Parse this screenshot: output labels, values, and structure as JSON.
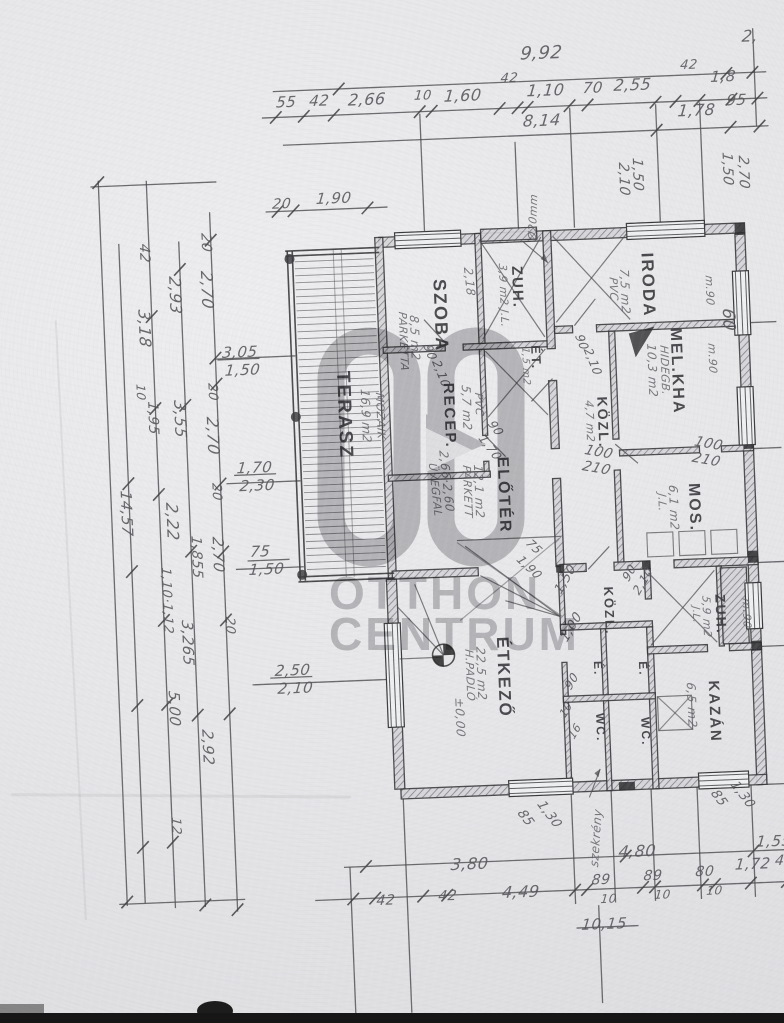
{
  "document": {
    "kind": "scanned hand-drawn floor plan",
    "language": "hu"
  },
  "colors": {
    "paper": "#e8e8ea",
    "ink": "#4b4b4f",
    "ink_dark": "#2b2b2e",
    "watermark_gray": "#97979a",
    "scan_bar": "#161616"
  },
  "watermark": {
    "logo": "OC",
    "line1": "OTTHON",
    "line2": "CENTRUM"
  },
  "labels": [
    {
      "t": "9,92",
      "x": 540,
      "y": 44,
      "fs": 18,
      "n": "dim-overall-top"
    },
    {
      "t": "2,",
      "x": 762,
      "y": 36,
      "fs": 16,
      "n": "dim-top"
    },
    {
      "t": "55",
      "x": 294,
      "y": 84,
      "fs": 15
    },
    {
      "t": "42",
      "x": 327,
      "y": 84,
      "fs": 15
    },
    {
      "t": "2,66",
      "x": 366,
      "y": 84,
      "fs": 16
    },
    {
      "t": "10",
      "x": 432,
      "y": 84,
      "fs": 13
    },
    {
      "t": "1,60",
      "x": 462,
      "y": 84,
      "fs": 16
    },
    {
      "t": "42",
      "x": 519,
      "y": 70,
      "fs": 13
    },
    {
      "t": "1,10",
      "x": 545,
      "y": 82,
      "fs": 16
    },
    {
      "t": "70",
      "x": 601,
      "y": 82,
      "fs": 15
    },
    {
      "t": "2,55",
      "x": 632,
      "y": 80,
      "fs": 16
    },
    {
      "t": "42",
      "x": 699,
      "y": 64,
      "fs": 13
    },
    {
      "t": "1,8",
      "x": 729,
      "y": 76,
      "fs": 15
    },
    {
      "t": "8,14",
      "x": 540,
      "y": 112,
      "fs": 16
    },
    {
      "t": "1,78",
      "x": 695,
      "y": 108,
      "fs": 16
    },
    {
      "t": "95",
      "x": 744,
      "y": 100,
      "fs": 15
    },
    {
      "t": "20",
      "x": 286,
      "y": 186,
      "fs": 14
    },
    {
      "t": "1,90",
      "x": 330,
      "y": 182,
      "fs": 15
    },
    {
      "t": "1,50",
      "x": 658,
      "y": 162,
      "r": 90,
      "fs": 14
    },
    {
      "t": "2,10",
      "x": 644,
      "y": 166,
      "r": 90,
      "fs": 14
    },
    {
      "t": "1,50",
      "x": 748,
      "y": 160,
      "r": 90,
      "fs": 14
    },
    {
      "t": "2,70",
      "x": 764,
      "y": 164,
      "r": 90,
      "fs": 14
    },
    {
      "t": "m.90",
      "x": 724,
      "y": 282,
      "r": 90,
      "fs": 11,
      "c": "hand"
    },
    {
      "t": "m.90",
      "x": 724,
      "y": 350,
      "r": 90,
      "fs": 11,
      "c": "hand"
    },
    {
      "t": "60",
      "x": 744,
      "y": 316,
      "r": 90,
      "fs": 17
    },
    {
      "t": "100",
      "x": 700,
      "y": 440,
      "r": 12,
      "fs": 14
    },
    {
      "t": "210",
      "x": 697,
      "y": 456,
      "r": 12,
      "fs": 14
    },
    {
      "t": "m.90",
      "x": 748,
      "y": 606,
      "r": 90,
      "fs": 11,
      "c": "hand"
    },
    {
      "t": "42",
      "x": 162,
      "y": 228,
      "r": 90,
      "fs": 14
    },
    {
      "t": "20",
      "x": 224,
      "y": 220,
      "r": 90,
      "fs": 14
    },
    {
      "t": "2,93",
      "x": 192,
      "y": 262,
      "r": 90,
      "fs": 16
    },
    {
      "t": "2,70",
      "x": 224,
      "y": 258,
      "r": 90,
      "fs": 16
    },
    {
      "t": "3,18",
      "x": 160,
      "y": 294,
      "r": 90,
      "fs": 16
    },
    {
      "t": "10",
      "x": 152,
      "y": 368,
      "r": 90,
      "fs": 12
    },
    {
      "t": "3,05",
      "x": 230,
      "y": 332,
      "fs": 15
    },
    {
      "t": "1,50",
      "x": 232,
      "y": 350,
      "fs": 15
    },
    {
      "t": "20",
      "x": 224,
      "y": 370,
      "r": 90,
      "fs": 13
    },
    {
      "t": "3,55",
      "x": 192,
      "y": 386,
      "r": 90,
      "fs": 16
    },
    {
      "t": "2,70",
      "x": 224,
      "y": 404,
      "r": 90,
      "fs": 16
    },
    {
      "t": "1,95",
      "x": 164,
      "y": 386,
      "r": 90,
      "fs": 14
    },
    {
      "t": "1,70",
      "x": 240,
      "y": 448,
      "fs": 15
    },
    {
      "t": "2,30",
      "x": 242,
      "y": 466,
      "fs": 15
    },
    {
      "t": "20",
      "x": 224,
      "y": 470,
      "r": 90,
      "fs": 13
    },
    {
      "t": "2,22",
      "x": 180,
      "y": 488,
      "r": 90,
      "fs": 16
    },
    {
      "t": "14,57",
      "x": 134,
      "y": 474,
      "r": 90,
      "fs": 15
    },
    {
      "t": "1,855",
      "x": 202,
      "y": 522,
      "r": 90,
      "fs": 14
    },
    {
      "t": "75",
      "x": 250,
      "y": 532,
      "fs": 15
    },
    {
      "t": "1,50",
      "x": 248,
      "y": 550,
      "fs": 15
    },
    {
      "t": "2,70",
      "x": 224,
      "y": 524,
      "r": 90,
      "fs": 15
    },
    {
      "t": "1,10·1,12",
      "x": 170,
      "y": 552,
      "r": 90,
      "fs": 13
    },
    {
      "t": "20",
      "x": 232,
      "y": 604,
      "r": 90,
      "fs": 13
    },
    {
      "t": "3,265",
      "x": 190,
      "y": 606,
      "r": 90,
      "fs": 15
    },
    {
      "t": "2,50",
      "x": 270,
      "y": 652,
      "fs": 15
    },
    {
      "t": "2,10",
      "x": 272,
      "y": 670,
      "fs": 15
    },
    {
      "t": "5,00",
      "x": 174,
      "y": 676,
      "r": 90,
      "fs": 15
    },
    {
      "t": "2,92",
      "x": 206,
      "y": 716,
      "r": 90,
      "fs": 15
    },
    {
      "t": "12",
      "x": 170,
      "y": 802,
      "r": 90,
      "fs": 13
    },
    {
      "t": "Ø20mm",
      "x": 538,
      "y": 238,
      "r": -86,
      "fs": 11,
      "c": "hand",
      "n": "leader-note"
    },
    {
      "t": "90",
      "x": 592,
      "y": 334,
      "r": 70,
      "fs": 12
    },
    {
      "t": "2,10",
      "x": 600,
      "y": 348,
      "r": 70,
      "fs": 12
    },
    {
      "t": "90",
      "x": 440,
      "y": 338,
      "r": 70,
      "fs": 12
    },
    {
      "t": "2,10",
      "x": 448,
      "y": 354,
      "r": 70,
      "fs": 12
    },
    {
      "t": "2,18",
      "x": 484,
      "y": 264,
      "r": 86,
      "fs": 12,
      "c": "hand"
    },
    {
      "t": "90",
      "x": 500,
      "y": 416,
      "r": 55,
      "fs": 12
    },
    {
      "t": "1,70",
      "x": 490,
      "y": 430,
      "r": 55,
      "fs": 12
    },
    {
      "t": "100",
      "x": 590,
      "y": 444,
      "r": 12,
      "fs": 14
    },
    {
      "t": "210",
      "x": 587,
      "y": 460,
      "r": 12,
      "fs": 14
    },
    {
      "t": "75",
      "x": 532,
      "y": 536,
      "r": 45,
      "fs": 12
    },
    {
      "t": "1,90",
      "x": 522,
      "y": 552,
      "r": 45,
      "fs": 12
    },
    {
      "t": "1,50",
      "x": 550,
      "y": 588,
      "r": -58,
      "fs": 13
    },
    {
      "t": "1,00",
      "x": 554,
      "y": 636,
      "r": -58,
      "fs": 13
    },
    {
      "t": "90",
      "x": 556,
      "y": 684,
      "r": -58,
      "fs": 12
    },
    {
      "t": "10",
      "x": 550,
      "y": 712,
      "r": -58,
      "fs": 11
    },
    {
      "t": "16",
      "x": 558,
      "y": 734,
      "r": -58,
      "fs": 11
    },
    {
      "t": "90",
      "x": 618,
      "y": 578,
      "r": -58,
      "fs": 12
    },
    {
      "t": "2,10",
      "x": 628,
      "y": 592,
      "r": -58,
      "fs": 12
    },
    {
      "t": "±0,00",
      "x": 458,
      "y": 694,
      "r": 90,
      "fs": 12,
      "c": "hand",
      "n": "elevation-value"
    },
    {
      "t": "TERASZ",
      "x": 358,
      "y": 362,
      "r": 90,
      "fs": 19,
      "c": "room",
      "n": "room-terasz"
    },
    {
      "t": "16,9 m2",
      "x": 376,
      "y": 382,
      "r": 90,
      "fs": 12,
      "c": "hand"
    },
    {
      "t": "MOZAIK",
      "x": 390,
      "y": 386,
      "r": 90,
      "fs": 11,
      "c": "hand"
    },
    {
      "t": "SZOBA",
      "x": 458,
      "y": 274,
      "r": 90,
      "fs": 18,
      "c": "room",
      "n": "room-szoba"
    },
    {
      "t": "8,5 m2",
      "x": 428,
      "y": 310,
      "r": 90,
      "fs": 12,
      "c": "hand"
    },
    {
      "t": "PARKETTA",
      "x": 416,
      "y": 306,
      "r": 90,
      "fs": 11,
      "c": "hand"
    },
    {
      "t": "ZUH.",
      "x": 534,
      "y": 264,
      "r": 90,
      "fs": 15,
      "c": "room",
      "n": "room-zuh-1"
    },
    {
      "t": "3,9 m2 J.L.",
      "x": 518,
      "y": 262,
      "r": 90,
      "fs": 11,
      "c": "hand"
    },
    {
      "t": "ÉT.",
      "x": 549,
      "y": 344,
      "r": 90,
      "fs": 13,
      "c": "room",
      "n": "room-et"
    },
    {
      "t": "1,5 m2",
      "x": 536,
      "y": 346,
      "r": 90,
      "fs": 10,
      "c": "hand"
    },
    {
      "t": "IRODA",
      "x": 666,
      "y": 256,
      "r": 90,
      "fs": 17,
      "c": "room",
      "n": "room-iroda"
    },
    {
      "t": "7,5 m2",
      "x": 640,
      "y": 272,
      "r": 90,
      "fs": 12,
      "c": "hand"
    },
    {
      "t": "PVC",
      "x": 628,
      "y": 280,
      "r": 90,
      "fs": 11,
      "c": "hand"
    },
    {
      "t": "MEL.KHA",
      "x": 690,
      "y": 332,
      "r": 90,
      "fs": 16,
      "c": "room",
      "n": "room-melkha"
    },
    {
      "t": "10,3 m2",
      "x": 664,
      "y": 348,
      "r": 90,
      "fs": 12,
      "c": "hand"
    },
    {
      "t": "HIDEGB.",
      "x": 676,
      "y": 350,
      "r": 90,
      "fs": 11,
      "c": "hand"
    },
    {
      "t": "KÖZL.",
      "x": 614,
      "y": 398,
      "r": 90,
      "fs": 14,
      "c": "room",
      "n": "room-kozl-1"
    },
    {
      "t": "4,7 m2",
      "x": 599,
      "y": 402,
      "r": 90,
      "fs": 11,
      "c": "hand"
    },
    {
      "t": "RECEP.",
      "x": 461,
      "y": 378,
      "r": 90,
      "fs": 15,
      "c": "room",
      "n": "room-recep"
    },
    {
      "t": "5,7 m2",
      "x": 477,
      "y": 382,
      "r": 90,
      "fs": 12,
      "c": "hand"
    },
    {
      "t": "PVC",
      "x": 489,
      "y": 390,
      "r": 90,
      "fs": 11,
      "c": "hand"
    },
    {
      "t": "ELŐTÉR",
      "x": 512,
      "y": 454,
      "r": 90,
      "fs": 16,
      "c": "room",
      "n": "room-eloter"
    },
    {
      "t": "12,1 m2",
      "x": 486,
      "y": 462,
      "r": 90,
      "fs": 12,
      "c": "hand"
    },
    {
      "t": "PARKETT",
      "x": 474,
      "y": 462,
      "r": 90,
      "fs": 11,
      "c": "hand"
    },
    {
      "t": "2,66·2,60",
      "x": 452,
      "y": 446,
      "r": 86,
      "fs": 12,
      "c": "hand",
      "n": "note-uvegfal-size"
    },
    {
      "t": "ÜVEGFAL",
      "x": 440,
      "y": 458,
      "r": 86,
      "fs": 11,
      "c": "hand",
      "n": "note-uvegfal"
    },
    {
      "t": "MOS.",
      "x": 702,
      "y": 488,
      "r": 90,
      "fs": 16,
      "c": "room",
      "n": "room-mos"
    },
    {
      "t": "6,1 m2",
      "x": 680,
      "y": 490,
      "r": 90,
      "fs": 12,
      "c": "hand"
    },
    {
      "t": "J.L.",
      "x": 668,
      "y": 498,
      "r": 90,
      "fs": 11,
      "c": "hand"
    },
    {
      "t": "ÉTKEZŐ",
      "x": 506,
      "y": 634,
      "r": 90,
      "fs": 17,
      "c": "room",
      "n": "room-etkezo"
    },
    {
      "t": "22,5 m2",
      "x": 481,
      "y": 644,
      "r": 90,
      "fs": 12,
      "c": "hand"
    },
    {
      "t": "H.PADLÓ",
      "x": 469,
      "y": 646,
      "r": 90,
      "fs": 11,
      "c": "hand"
    },
    {
      "t": "KÖZL.",
      "x": 612,
      "y": 588,
      "r": 90,
      "fs": 13,
      "c": "room",
      "n": "room-kozl-2"
    },
    {
      "t": "É.",
      "x": 598,
      "y": 662,
      "r": 90,
      "fs": 12,
      "c": "room",
      "n": "room-e-1"
    },
    {
      "t": "WC.",
      "x": 598,
      "y": 714,
      "r": 90,
      "fs": 12,
      "c": "room",
      "n": "room-wc-1"
    },
    {
      "t": "É.",
      "x": 643,
      "y": 664,
      "r": 90,
      "fs": 12,
      "c": "room",
      "n": "room-e-2"
    },
    {
      "t": "WC.",
      "x": 643,
      "y": 720,
      "r": 90,
      "fs": 12,
      "c": "room",
      "n": "room-wc-2"
    },
    {
      "t": "ZUH.",
      "x": 724,
      "y": 600,
      "r": 90,
      "fs": 14,
      "c": "room",
      "n": "room-zuh-2"
    },
    {
      "t": "5,9 m2",
      "x": 708,
      "y": 602,
      "r": 90,
      "fs": 11,
      "c": "hand"
    },
    {
      "t": "J.L.",
      "x": 696,
      "y": 612,
      "r": 90,
      "fs": 10,
      "c": "hand"
    },
    {
      "t": "KAZÁN",
      "x": 714,
      "y": 686,
      "r": 90,
      "fs": 15,
      "c": "room",
      "n": "room-kazan"
    },
    {
      "t": "6,5 m2",
      "x": 690,
      "y": 688,
      "r": 90,
      "fs": 12,
      "c": "hand"
    },
    {
      "t": "1,30",
      "x": 534,
      "y": 798,
      "r": 55,
      "fs": 13
    },
    {
      "t": "85",
      "x": 514,
      "y": 806,
      "r": 55,
      "fs": 13
    },
    {
      "t": "1,30",
      "x": 728,
      "y": 786,
      "r": 55,
      "fs": 13
    },
    {
      "t": "85",
      "x": 708,
      "y": 794,
      "r": 55,
      "fs": 13
    },
    {
      "t": "szekrény",
      "x": 574,
      "y": 866,
      "r": -84,
      "fs": 12,
      "c": "hand",
      "n": "note-szekreny"
    },
    {
      "t": "3,80",
      "x": 438,
      "y": 852,
      "fs": 16
    },
    {
      "t": "4,80",
      "x": 606,
      "y": 846,
      "fs": 16
    },
    {
      "t": "1,55",
      "x": 744,
      "y": 842,
      "fs": 15
    },
    {
      "t": "42",
      "x": 362,
      "y": 886,
      "fs": 14
    },
    {
      "t": "42",
      "x": 424,
      "y": 884,
      "fs": 14
    },
    {
      "t": "4,49",
      "x": 488,
      "y": 882,
      "fs": 16
    },
    {
      "t": "89",
      "x": 578,
      "y": 874,
      "fs": 14
    },
    {
      "t": "10",
      "x": 586,
      "y": 894,
      "fs": 12
    },
    {
      "t": "89",
      "x": 630,
      "y": 872,
      "fs": 14
    },
    {
      "t": "10",
      "x": 640,
      "y": 892,
      "fs": 12
    },
    {
      "t": "80",
      "x": 682,
      "y": 870,
      "fs": 14
    },
    {
      "t": "10",
      "x": 692,
      "y": 890,
      "fs": 12
    },
    {
      "t": "1,72",
      "x": 722,
      "y": 864,
      "fs": 15
    },
    {
      "t": "42",
      "x": 762,
      "y": 862,
      "fs": 14
    },
    {
      "t": "10,15",
      "x": 566,
      "y": 918,
      "fs": 15,
      "n": "dim-strikethrough"
    }
  ]
}
